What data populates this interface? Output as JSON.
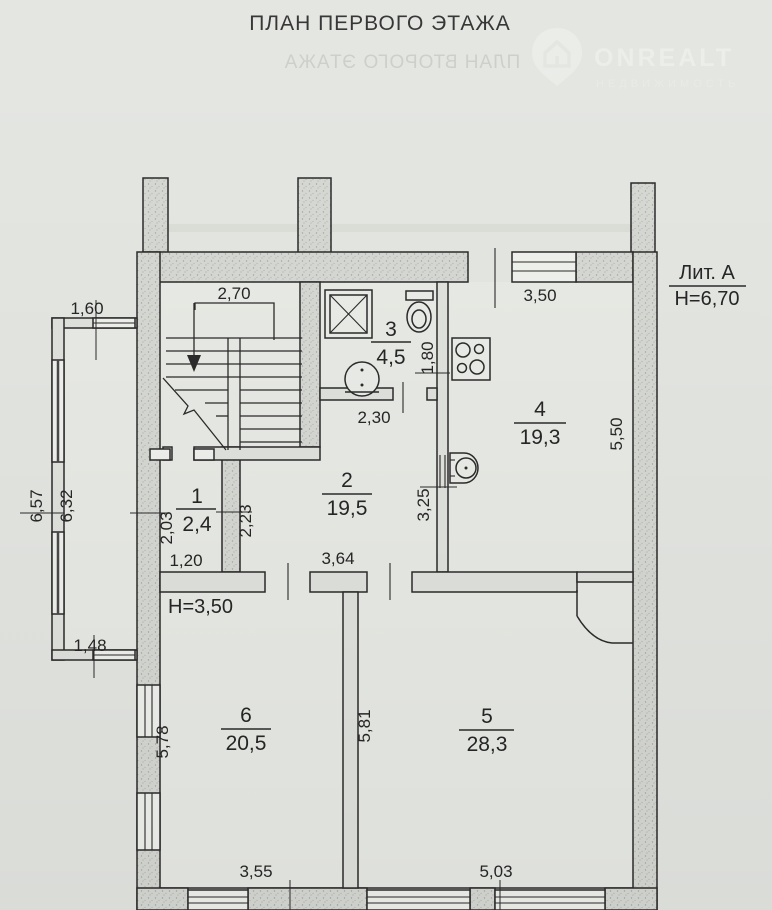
{
  "title": "ПЛАН ПЕРВОГО ЭТАЖА",
  "watermarks": {
    "ghost_title": "ПЛАН ВТОРОГО ЭТАЖА",
    "brand": "ONREALT",
    "brand_subtitle": "НЕДВИЖИМОСТЬ"
  },
  "legend": {
    "building_letter": "Лит. А",
    "building_height": "Н=6,70",
    "floor_height": "Н=3,50"
  },
  "rooms": {
    "room1": {
      "number": "1",
      "area": "2,4"
    },
    "room2": {
      "number": "2",
      "area": "19,5"
    },
    "room3": {
      "number": "3",
      "area": "4,5"
    },
    "room4": {
      "number": "4",
      "area": "19,3"
    },
    "room5": {
      "number": "5",
      "area": "28,3"
    },
    "room6": {
      "number": "6",
      "area": "20,5"
    }
  },
  "dimensions": {
    "stair_width": "2,70",
    "balcony_width_top": "1,60",
    "balcony_length_outer": "6,57",
    "balcony_length_inner": "6,32",
    "balcony_width_bottom": "1,48",
    "room1_depth": "2,03",
    "room1_width": "1,20",
    "room2_left": "2,23",
    "hall_top_width": "2,30",
    "room2_width": "3,64",
    "room2_right": "3,25",
    "bathroom_depth": "1,80",
    "kitchen_width_top": "3,50",
    "kitchen_depth_right": "5,50",
    "room6_depth": "5,78",
    "room6_width": "3,55",
    "room5_depth": "5,81",
    "room5_width": "5,03"
  },
  "colors": {
    "paper": "#e3e5e1",
    "ink": "#2b2b2b",
    "wall_fill": "#d6d8d3"
  }
}
